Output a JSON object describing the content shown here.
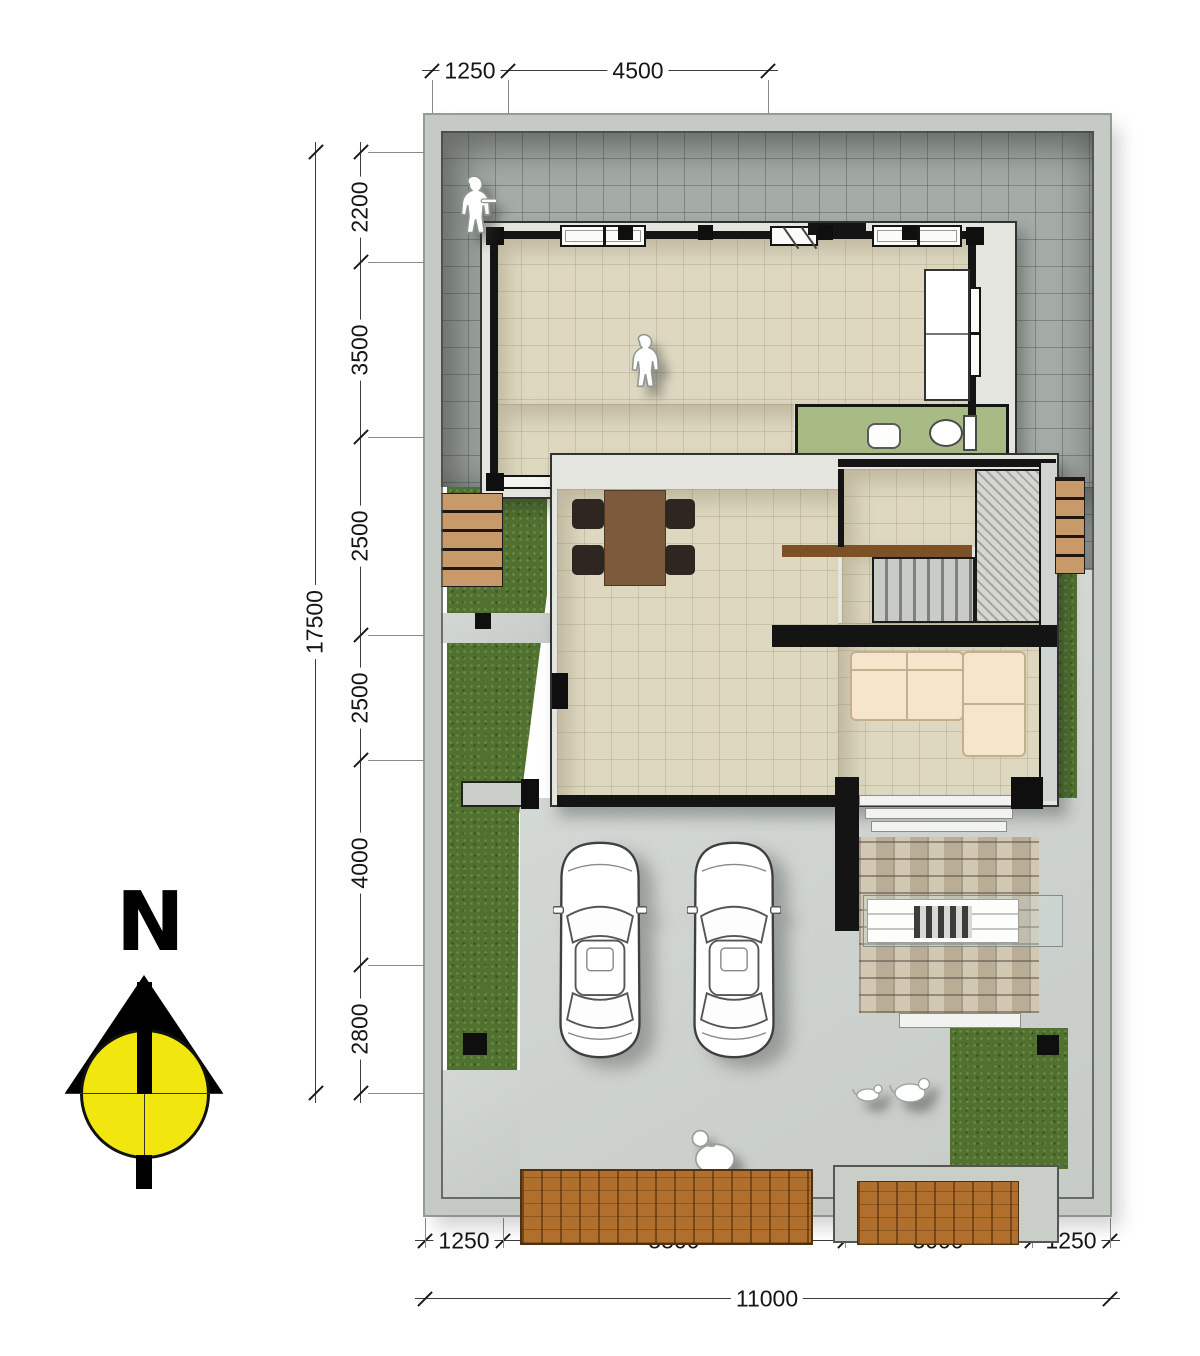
{
  "compass": {
    "label": "N",
    "dial_color": "#f2e60f",
    "needle_color": "#000000"
  },
  "dimensions": {
    "top": {
      "segments": [
        "1250",
        "4500"
      ]
    },
    "left": {
      "segments": [
        "2200",
        "3500",
        "2500",
        "2500",
        "4000",
        "2800"
      ],
      "total": "17500"
    },
    "bottom": {
      "segments": [
        "1250",
        "5500",
        "3000",
        "1250"
      ],
      "total": "11000"
    }
  },
  "palette": {
    "boundary_wall": "#c5cac5",
    "yard_tiles": "#a5aba7",
    "interior_floor": "#ded8c1",
    "bathroom_floor": "#a9bb84",
    "lawn": "#50722e",
    "concrete": "#ccd1cd",
    "wood_deck": "#b06f2c",
    "planter_wood": "#c99a69",
    "patio_brick": "#cbbfa6",
    "sofa": "#f5e5cb",
    "dining_table": "#7b5b3b",
    "wall_line": "#141414",
    "compass_dial": "#f2e60f"
  },
  "figures": {
    "vehicles": [
      "car-top-view",
      "car-top-view"
    ],
    "people": [
      "person-backyard",
      "person-main-room",
      "person-driveway"
    ],
    "animals": [
      "dog",
      "dog"
    ],
    "fixtures": [
      "toilet",
      "wash-basin",
      "sofa",
      "dining-table",
      "staircase",
      "bench-table"
    ]
  }
}
